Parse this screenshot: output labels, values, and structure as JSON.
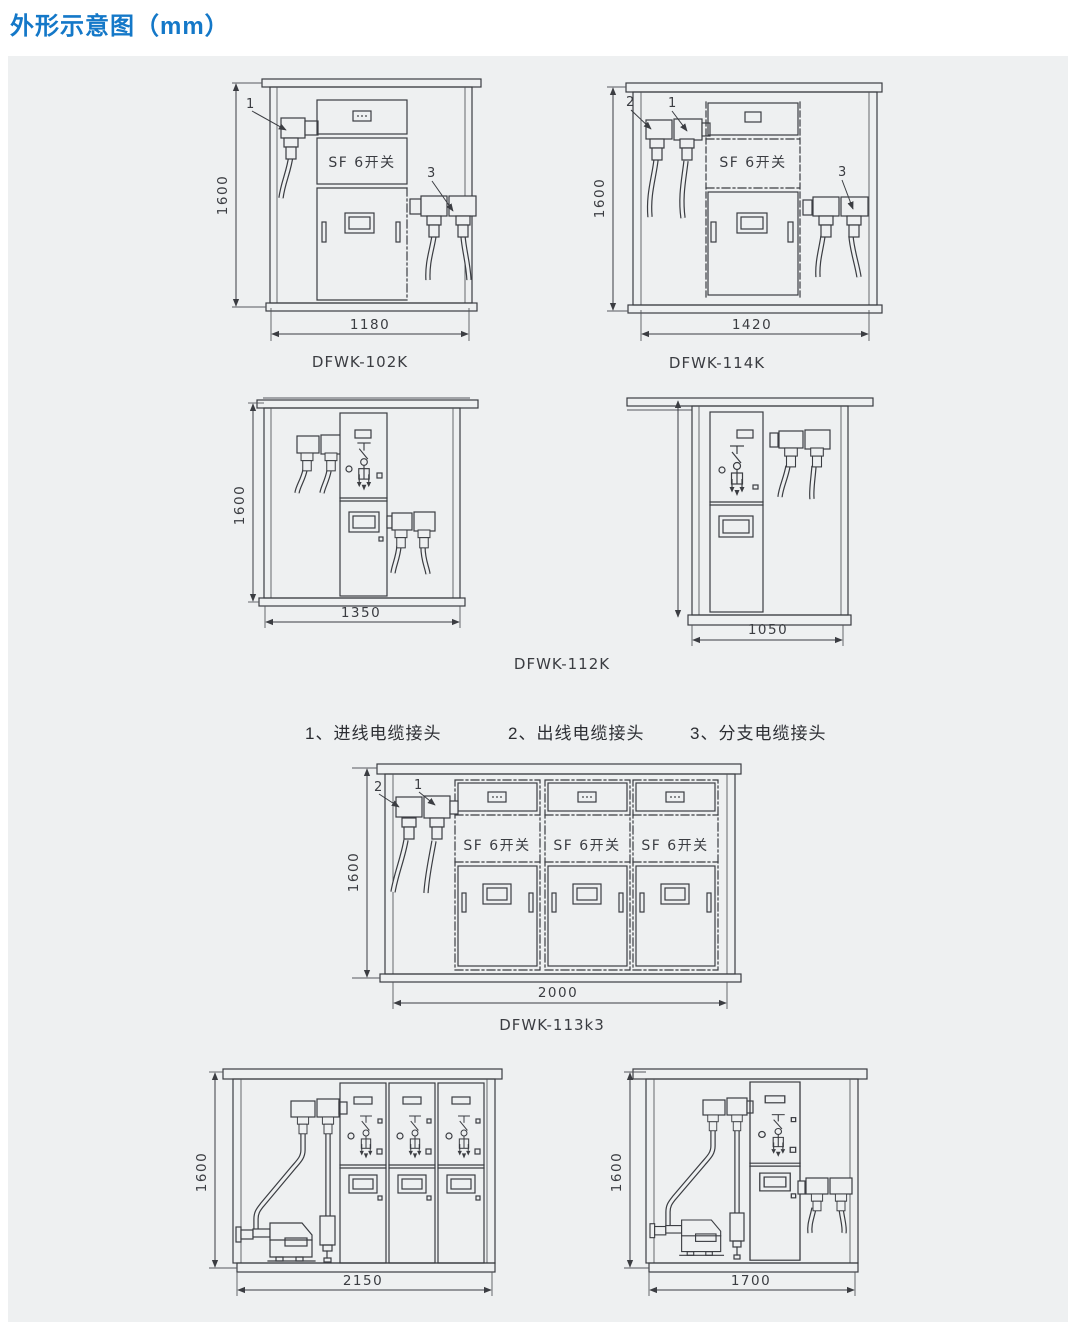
{
  "page": {
    "title": "外形示意图（mm）"
  },
  "colors": {
    "title_blue": "#1478c8",
    "panel_bg": "#eef0f1",
    "line": "#3b3d42"
  },
  "legend": {
    "items": [
      "1、进线电缆接头",
      "2、出线电缆接头",
      "3、分支电缆接头"
    ]
  },
  "drawings": {
    "d102k": {
      "label": "DFWK-102K",
      "width": "1180",
      "height": "1600",
      "sf": "SF 6开关",
      "c1": "1",
      "c3": "3"
    },
    "d114k": {
      "label": "DFWK-114K",
      "width": "1420",
      "height": "1600",
      "sf": "SF 6开关",
      "c1": "1",
      "c2": "2",
      "c3": "3"
    },
    "d112k": {
      "label": "DFWK-112K",
      "width": "1350",
      "height": "1600"
    },
    "d1050": {
      "width": "1050"
    },
    "d113k3": {
      "label": "DFWK-113k3",
      "width": "2000",
      "height": "1600",
      "sf": "SF 6开关",
      "c1": "1",
      "c2": "2"
    },
    "d2150": {
      "width": "2150",
      "height": "1600"
    },
    "d1700": {
      "width": "1700",
      "height": "1600"
    }
  }
}
